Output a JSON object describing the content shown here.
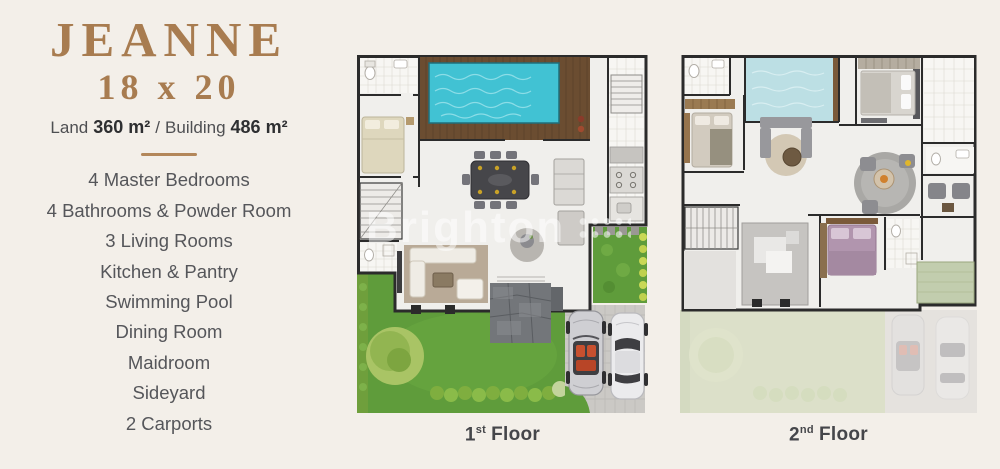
{
  "header": {
    "title": "JEANNE",
    "dimensions": "18 x 20",
    "area": {
      "land_label": "Land",
      "land_value": "360 m²",
      "separator": "/",
      "building_label": "Building",
      "building_value": "486 m²"
    }
  },
  "features": {
    "items": [
      "4 Master Bedrooms",
      "4 Bathrooms & Powder Room",
      "3 Living Rooms",
      "Kitchen & Pantry",
      "Swimming Pool",
      "Dining Room",
      "Maidroom",
      "Sideyard",
      "2 Carports"
    ]
  },
  "floors": [
    {
      "number": "1",
      "ordinal": "st",
      "word": "Floor"
    },
    {
      "number": "2",
      "ordinal": "nd",
      "word": "Floor"
    }
  ],
  "watermark": {
    "text": "Brighton"
  },
  "colors": {
    "background": "#f3efe9",
    "accent_brown": "#a87c50",
    "divider_brown": "#b3875a",
    "text_gray": "#55565a",
    "wall_dark": "#2b2b2b",
    "pool_teal": "#41c2d3",
    "garden_green": "#5f9c3b",
    "deck_wood": "#6b4d31"
  }
}
